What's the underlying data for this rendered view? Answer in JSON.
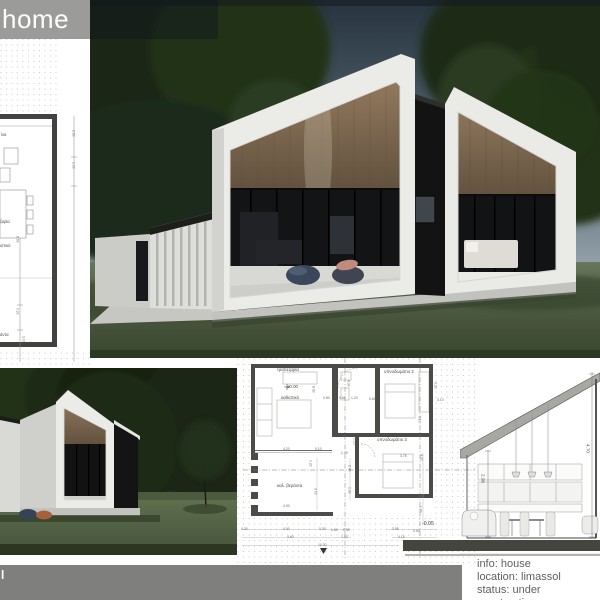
{
  "header": {
    "home_label": "home"
  },
  "footer": {
    "bar_fragment": "l",
    "info_lines": [
      "info: house",
      "location: limassol",
      "status: under construction"
    ]
  },
  "left_plan": {
    "labels": [
      {
        "t": "ίνα",
        "x": 1,
        "y": 133
      },
      {
        "t": "ζαρία",
        "x": 0,
        "y": 220
      },
      {
        "t": "ιστικό",
        "x": 0,
        "y": 244
      },
      {
        "t": "άντα",
        "x": 0,
        "y": 333
      }
    ],
    "dims": [
      {
        "t": "2.50",
        "x": 71,
        "y": 130,
        "rot": true
      },
      {
        "t": "1.00",
        "x": 71,
        "y": 162,
        "rot": true
      },
      {
        "t": "6.50",
        "x": 15,
        "y": 236,
        "rot": true
      },
      {
        "t": "0.20",
        "x": 15,
        "y": 308,
        "rot": true
      },
      {
        "t": "3.00",
        "x": 21,
        "y": 336,
        "rot": true
      }
    ]
  },
  "floor_plan": {
    "rooms": [
      {
        "t": "τραπεζαρία",
        "x": 40,
        "y": 10
      },
      {
        "t": "±0.00",
        "x": 50,
        "y": 27
      },
      {
        "t": "καθιστικό",
        "x": 44,
        "y": 38
      },
      {
        "t": "υπνοδωμάτιο 2",
        "x": 147,
        "y": 12
      },
      {
        "t": "υπνοδωμάτιο 3",
        "x": 140,
        "y": 80
      },
      {
        "t": "καλ. βεράντα",
        "x": 40,
        "y": 126
      },
      {
        "t": "-0.05",
        "x": 185,
        "y": 164,
        "big": true
      }
    ],
    "dims": [
      {
        "t": "4.20",
        "x": 46,
        "y": 90
      },
      {
        "t": "0.10",
        "x": 78,
        "y": 90
      },
      {
        "t": "0.80",
        "x": 86,
        "y": 39
      },
      {
        "t": "0.60",
        "x": 102,
        "y": 39
      },
      {
        "t": "1.20",
        "x": 114,
        "y": 39
      },
      {
        "t": "0.60",
        "x": 132,
        "y": 40
      },
      {
        "t": "3.10",
        "x": 200,
        "y": 41
      },
      {
        "t": "8.90",
        "x": 74,
        "y": 28,
        "rot": true
      },
      {
        "t": "4.30",
        "x": 109,
        "y": 22,
        "rot": true
      },
      {
        "t": "3.20",
        "x": 196,
        "y": 24,
        "rot": true
      },
      {
        "t": "0.10",
        "x": 180,
        "y": 58,
        "rot": true
      },
      {
        "t": "1.10",
        "x": 115,
        "y": 80,
        "rot": true
      },
      {
        "t": "1.40",
        "x": 104,
        "y": 94
      },
      {
        "t": "3.75",
        "x": 163,
        "y": 97
      },
      {
        "t": "4.00",
        "x": 182,
        "y": 96,
        "rot": true
      },
      {
        "t": "0.20",
        "x": 71,
        "y": 102,
        "rot": true
      },
      {
        "t": "3.00",
        "x": 76,
        "y": 130,
        "rot": true
      },
      {
        "t": "4.00",
        "x": 46,
        "y": 147
      },
      {
        "t": "2.40",
        "x": 110,
        "y": 107,
        "rot": true
      },
      {
        "t": "0.30",
        "x": 110,
        "y": 129,
        "rot": true
      },
      {
        "t": "0.90",
        "x": 181,
        "y": 148,
        "rot": true
      },
      {
        "t": "0.30",
        "x": 4,
        "y": 170
      },
      {
        "t": "4.00",
        "x": 46,
        "y": 170
      },
      {
        "t": "0.30",
        "x": 82,
        "y": 170
      },
      {
        "t": "1.60",
        "x": 94,
        "y": 171
      },
      {
        "t": "0.30",
        "x": 106,
        "y": 171
      },
      {
        "t": "4.60",
        "x": 50,
        "y": 178
      },
      {
        "t": "1.90",
        "x": 104,
        "y": 178
      },
      {
        "t": "10.30",
        "x": 81,
        "y": 186
      },
      {
        "t": "3.55",
        "x": 155,
        "y": 170
      },
      {
        "t": "0.50",
        "x": 176,
        "y": 172
      },
      {
        "t": "4.15",
        "x": 161,
        "y": 178
      }
    ]
  },
  "section": {
    "dims": [
      {
        "t": "2.96",
        "x": 20,
        "y": 116,
        "rot": true
      },
      {
        "t": "4.70",
        "x": 125,
        "y": 86,
        "rot": true
      }
    ]
  },
  "colors": {
    "header_gray": "#9b9b99",
    "footer_gray": "#7f7f7d",
    "info_text": "#606060",
    "wood": "#8a7258",
    "lawn": "#51604a"
  }
}
